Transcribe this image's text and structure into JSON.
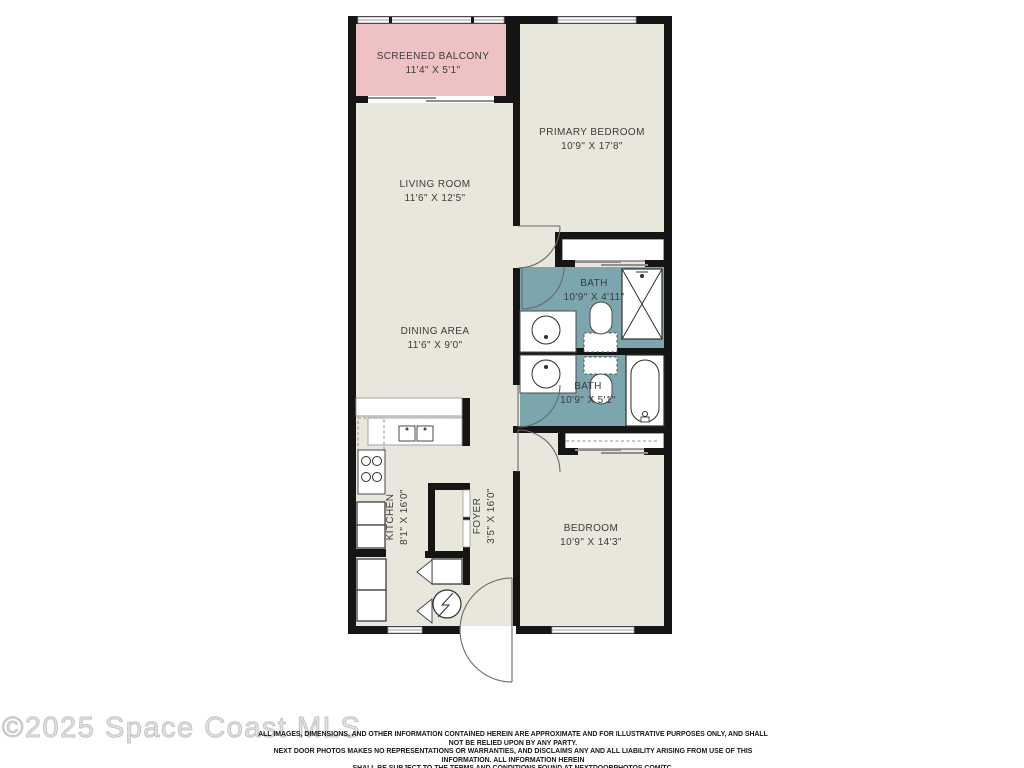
{
  "floor_plan": {
    "rooms": {
      "balcony": {
        "name": "SCREENED BALCONY",
        "dims": "11'4\" X 5'1\""
      },
      "primary_bedroom": {
        "name": "PRIMARY BEDROOM",
        "dims": "10'9\" X 17'8\""
      },
      "living_room": {
        "name": "LIVING ROOM",
        "dims": "11'6\" X 12'5\""
      },
      "dining_area": {
        "name": "DINING AREA",
        "dims": "11'6\" X 9'0\""
      },
      "bath_upper": {
        "name": "BATH",
        "dims": "10'9\" X 4'11\""
      },
      "bath_lower": {
        "name": "BATH",
        "dims": "10'9\" X 5'1\""
      },
      "kitchen": {
        "name": "KITCHEN",
        "dims": "8'1\" X 16'0\""
      },
      "foyer": {
        "name": "FOYER",
        "dims": "3'5\" X 16'0\""
      },
      "bedroom": {
        "name": "BEDROOM",
        "dims": "10'9\" X 14'3\""
      }
    },
    "colors": {
      "wall": "#151515",
      "floor": "#e9e7dc",
      "balcony": "#eec2c4",
      "bath": "#7ba6ae",
      "label_text": "#3b3b39"
    }
  },
  "watermark": "©2025 Space Coast MLS",
  "disclaimer": {
    "lines": [
      "ALL IMAGES, DIMENSIONS, AND OTHER INFORMATION CONTAINED HEREIN ARE APPROXIMATE AND FOR ILLUSTRATIVE PURPOSES ONLY, AND SHALL NOT BE RELIED UPON BY ANY PARTY.",
      "NEXT DOOR PHOTOS MAKES NO REPRESENTATIONS OR WARRANTIES, AND DISCLAIMS ANY AND ALL LIABILITY ARISING FROM USE OF THIS INFORMATION. ALL INFORMATION HEREIN",
      "SHALL BE SUBJECT TO THE TERMS AND CONDITIONS FOUND AT NEXTDOORPHOTOS.COM/TC."
    ]
  }
}
